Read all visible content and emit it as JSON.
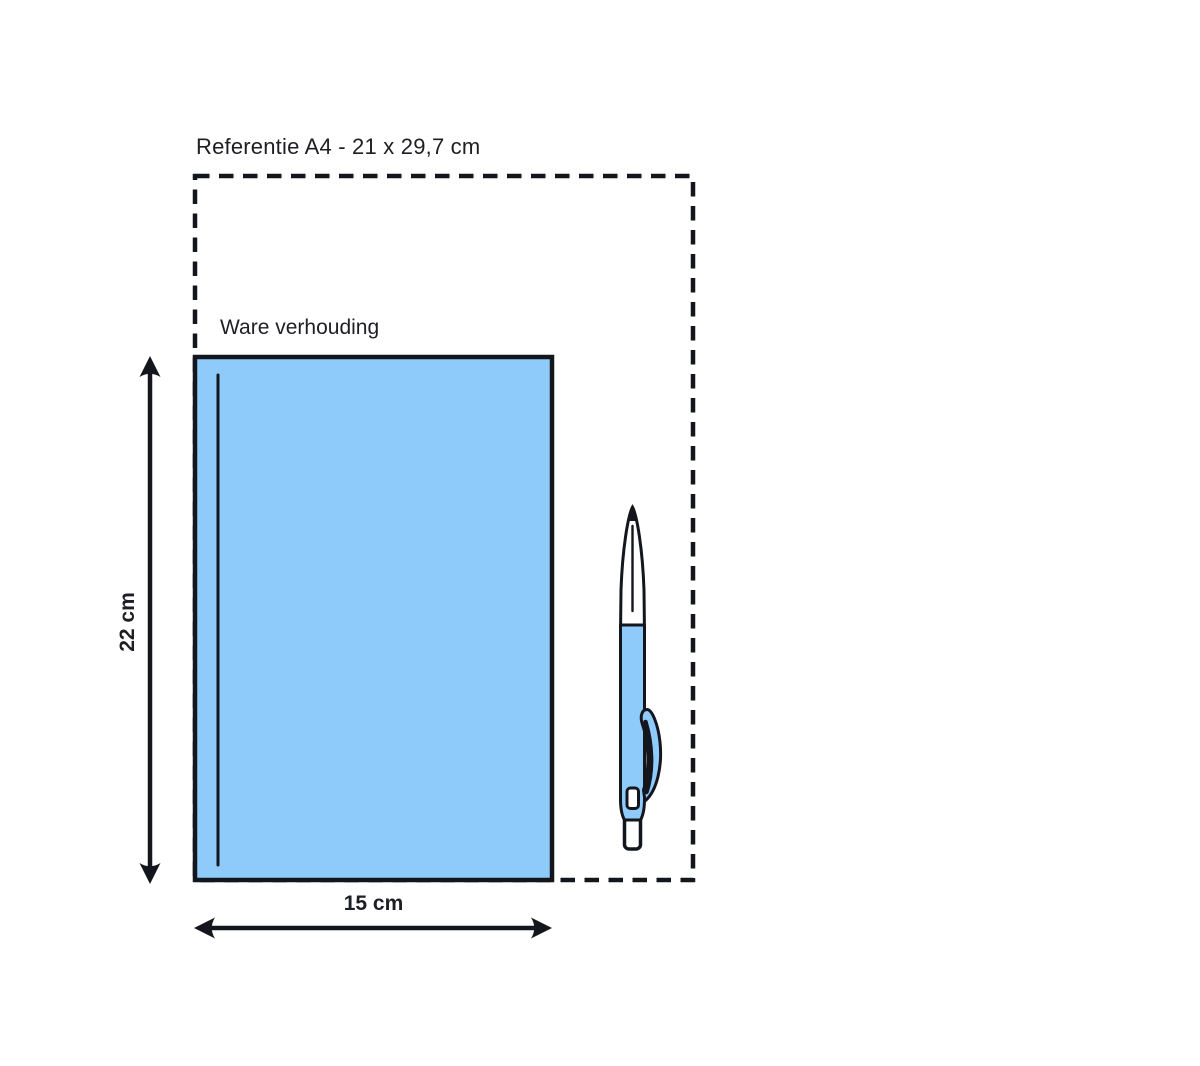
{
  "diagram": {
    "title": "Referentie A4 - 21 x 29,7 cm",
    "product_label": "Ware verhouding",
    "height_label": "22 cm",
    "width_label": "15 cm"
  },
  "colors": {
    "background": "#FFFFFF",
    "product_fill": "#8ECAFA",
    "outline": "#14161D",
    "text": "#1D1F24"
  },
  "icons": {
    "pen": "ballpoint-pen-illustration"
  }
}
